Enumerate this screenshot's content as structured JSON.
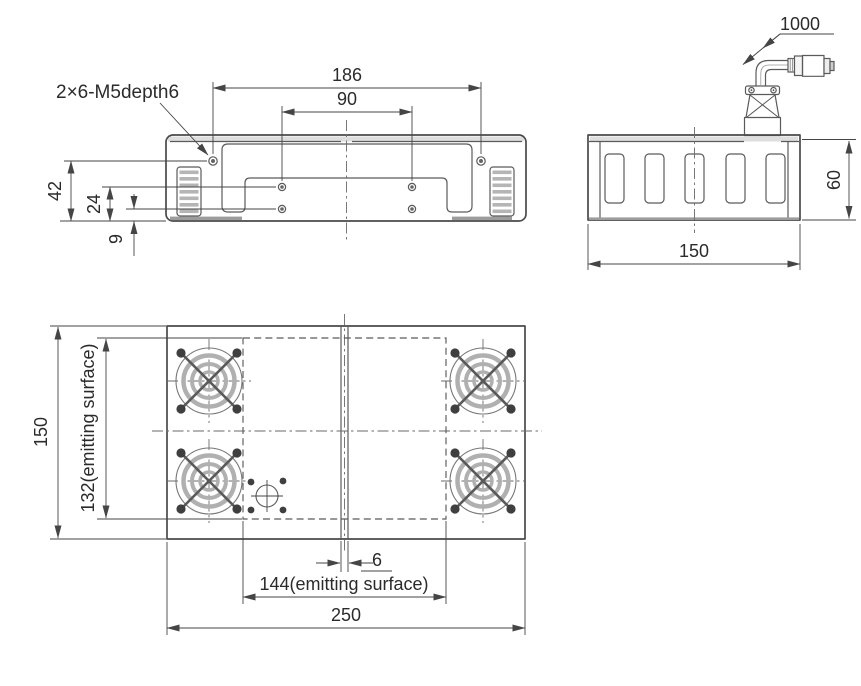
{
  "drawing": {
    "ink_color": "#4a4a4a",
    "front_view": {
      "thread_note": "2×6-M5depth6",
      "dims": {
        "outer_hole_spacing": "186",
        "inner_hole_spacing": "90",
        "upper_hole_height": "42",
        "mid_hole_height": "24",
        "lower_hole_height": "9"
      }
    },
    "side_view": {
      "dims": {
        "cable_length": "1000",
        "body_height": "60",
        "body_depth": "150"
      }
    },
    "top_view": {
      "dims": {
        "body_depth": "150",
        "emitting_depth": "132(emitting surface)",
        "emitting_width": "144(emitting surface)",
        "center_gap": "6",
        "body_width": "250"
      }
    }
  }
}
